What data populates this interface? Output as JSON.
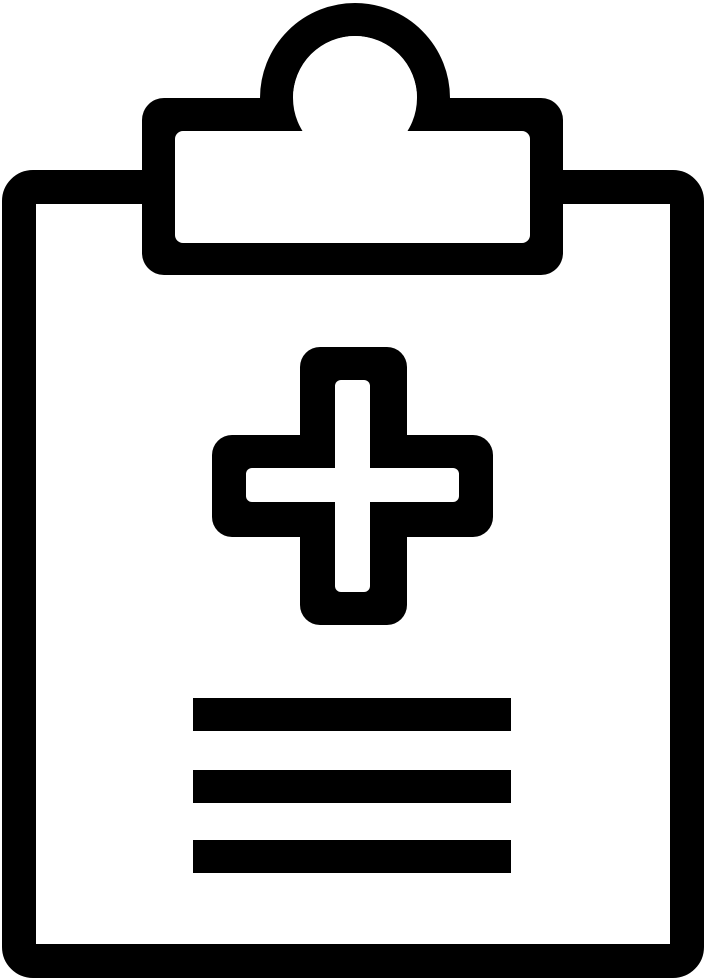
{
  "canvas": {
    "width": 706,
    "height": 980,
    "background_color": "#ffffff"
  },
  "icon": {
    "name": "medical-clipboard-icon",
    "ink_color": "#000000",
    "paper_color": "#ffffff",
    "parts": {
      "board_label": "clipboard-board-outline",
      "handle_label": "clip-handle-ring",
      "clip_label": "clipboard-clip",
      "clip_window_label": "clip-window",
      "cross_label": "medical-cross",
      "lines_label": "report-text-lines",
      "text_line_count": 3
    }
  }
}
